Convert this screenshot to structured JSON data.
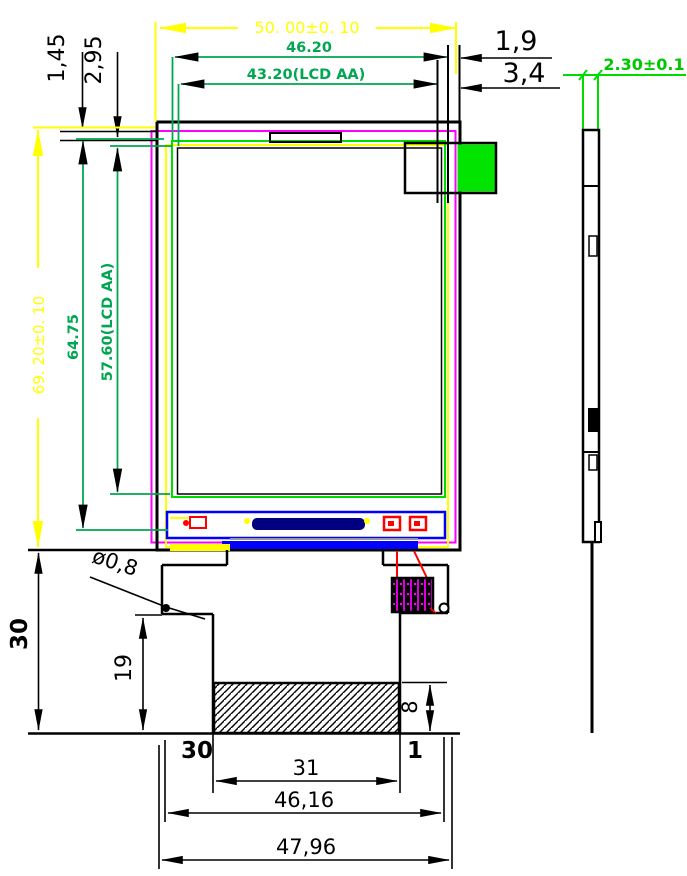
{
  "drawing_title": "LCD module outline drawing",
  "colors": {
    "outline_black": "#000000",
    "dim_yellow": "#FFFF00",
    "dim_green": "#00A651",
    "side_view_green": "#00DC00",
    "component_fill_green": "#00E400",
    "bezel_magenta": "#FF00FF",
    "frame_yellow": "#FFFF00",
    "fpc_blue": "#0000FF",
    "lens_navy": "#000080",
    "trace_red": "#FF0000"
  },
  "front_view": {
    "top_dimensions": {
      "overall_width": "50. 00±0. 10",
      "glass_width": "46.20",
      "active_area_width": "43.20(LCD AA)"
    },
    "right_offsets": {
      "offset_small": "1,9",
      "offset_large": "3,4"
    },
    "left_offsets": {
      "offset_small": "1,45",
      "offset_large": "2,95"
    },
    "left_dimensions": {
      "overall_height": "69. 20±0. 10",
      "glass_height": "64.75",
      "active_area_height": "57.60(LCD AA)"
    }
  },
  "side_view": {
    "thickness": "2.30±0.1"
  },
  "fpc": {
    "drop_height": "30",
    "notch_height": "19",
    "hole_diameter": "ø0,8",
    "contact_height": "8",
    "pin_first": "30",
    "pin_last": "1",
    "contact_width": "31",
    "width": "46,16",
    "overall_width": "47,96"
  }
}
